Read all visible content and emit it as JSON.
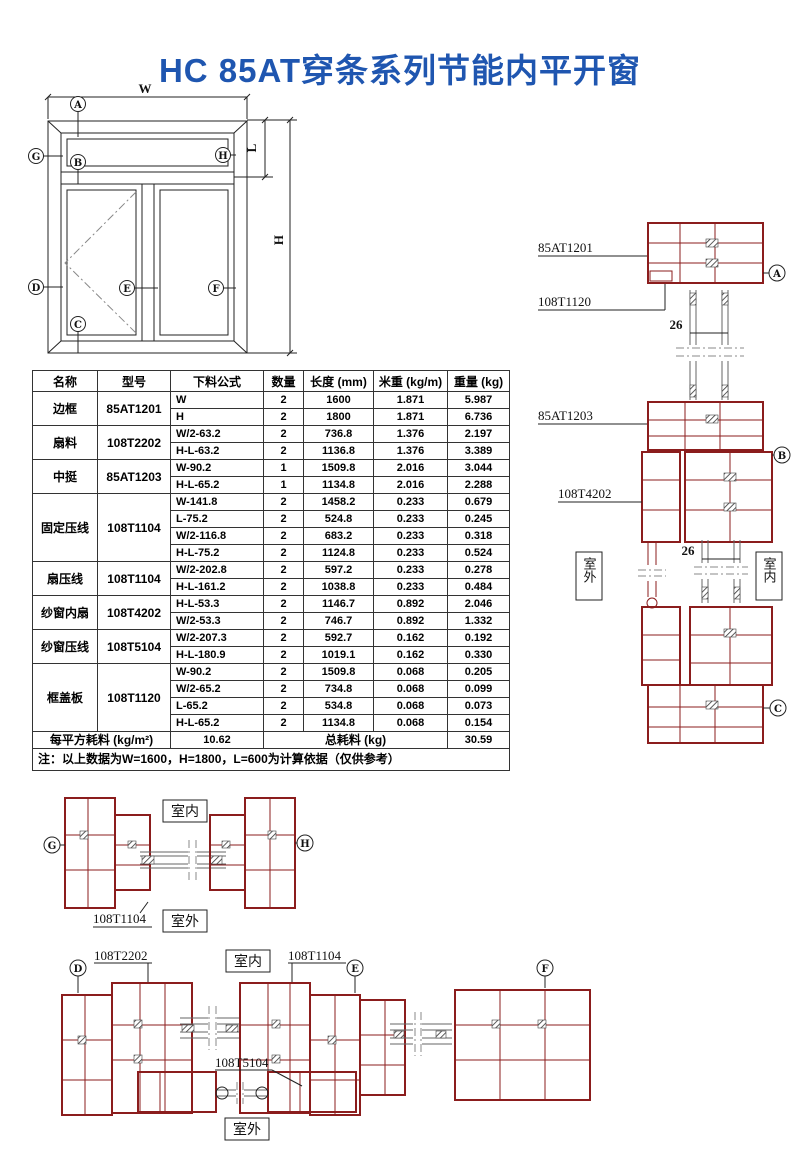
{
  "title": "HC 85AT穿条系列节能内平开窗",
  "colors": {
    "title_blue": "#1f56b0",
    "profile_red": "#8b1d1d",
    "line_black": "#222222"
  },
  "elevation": {
    "dim_w": "W",
    "dim_h": "H",
    "dim_l": "L",
    "markers": {
      "a": "A",
      "b": "B",
      "c": "C",
      "d": "D",
      "e": "E",
      "f": "F",
      "g": "G",
      "h": "H"
    }
  },
  "table": {
    "headers": [
      "名称",
      "型号",
      "下料公式",
      "数量",
      "长度 (mm)",
      "米重 (kg/m)",
      "重量 (kg)"
    ],
    "groups": [
      {
        "name": "边框",
        "model": "85AT1201",
        "rows": [
          [
            "W",
            "2",
            "1600",
            "1.871",
            "5.987"
          ],
          [
            "H",
            "2",
            "1800",
            "1.871",
            "6.736"
          ]
        ]
      },
      {
        "name": "扇料",
        "model": "108T2202",
        "rows": [
          [
            "W/2-63.2",
            "2",
            "736.8",
            "1.376",
            "2.197"
          ],
          [
            "H-L-63.2",
            "2",
            "1136.8",
            "1.376",
            "3.389"
          ]
        ]
      },
      {
        "name": "中挺",
        "model": "85AT1203",
        "rows": [
          [
            "W-90.2",
            "1",
            "1509.8",
            "2.016",
            "3.044"
          ],
          [
            "H-L-65.2",
            "1",
            "1134.8",
            "2.016",
            "2.288"
          ]
        ]
      },
      {
        "name": "固定压线",
        "model": "108T1104",
        "rows": [
          [
            "W-141.8",
            "2",
            "1458.2",
            "0.233",
            "0.679"
          ],
          [
            "L-75.2",
            "2",
            "524.8",
            "0.233",
            "0.245"
          ],
          [
            "W/2-116.8",
            "2",
            "683.2",
            "0.233",
            "0.318"
          ],
          [
            "H-L-75.2",
            "2",
            "1124.8",
            "0.233",
            "0.524"
          ]
        ]
      },
      {
        "name": "扇压线",
        "model": "108T1104",
        "rows": [
          [
            "W/2-202.8",
            "2",
            "597.2",
            "0.233",
            "0.278"
          ],
          [
            "H-L-161.2",
            "2",
            "1038.8",
            "0.233",
            "0.484"
          ]
        ]
      },
      {
        "name": "纱窗内扇",
        "model": "108T4202",
        "rows": [
          [
            "H-L-53.3",
            "2",
            "1146.7",
            "0.892",
            "2.046"
          ],
          [
            "W/2-53.3",
            "2",
            "746.7",
            "0.892",
            "1.332"
          ]
        ]
      },
      {
        "name": "纱窗压线",
        "model": "108T5104",
        "rows": [
          [
            "W/2-207.3",
            "2",
            "592.7",
            "0.162",
            "0.192"
          ],
          [
            "H-L-180.9",
            "2",
            "1019.1",
            "0.162",
            "0.330"
          ]
        ]
      },
      {
        "name": "框盖板",
        "model": "108T1120",
        "rows": [
          [
            "W-90.2",
            "2",
            "1509.8",
            "0.068",
            "0.205"
          ],
          [
            "W/2-65.2",
            "2",
            "734.8",
            "0.068",
            "0.099"
          ],
          [
            "L-65.2",
            "2",
            "534.8",
            "0.068",
            "0.073"
          ],
          [
            "H-L-65.2",
            "2",
            "1134.8",
            "0.068",
            "0.154"
          ]
        ]
      }
    ],
    "footer": {
      "label_left": "每平方耗料 (kg/m²)",
      "value_left": "10.62",
      "label_right": "总耗料 (kg)",
      "value_right": "30.59"
    },
    "note": "注：以上数据为W=1600，H=1800，L=600为计算依据（仅供参考）"
  },
  "sections": {
    "right": {
      "profile_labels": [
        "85AT1201",
        "108T1120",
        "85AT1203",
        "108T4202"
      ],
      "glass_dim": "26",
      "outdoor": "室外",
      "indoor": "室内",
      "markers": [
        "A",
        "B",
        "C"
      ]
    },
    "gh": {
      "profile_label": "108T1104",
      "indoor": "室内",
      "outdoor": "室外",
      "markers": [
        "G",
        "H"
      ]
    },
    "def": {
      "profile_labels": [
        "108T2202",
        "108T1104",
        "108T5104"
      ],
      "indoor": "室内",
      "outdoor": "室外",
      "markers": [
        "D",
        "E",
        "F"
      ]
    }
  }
}
